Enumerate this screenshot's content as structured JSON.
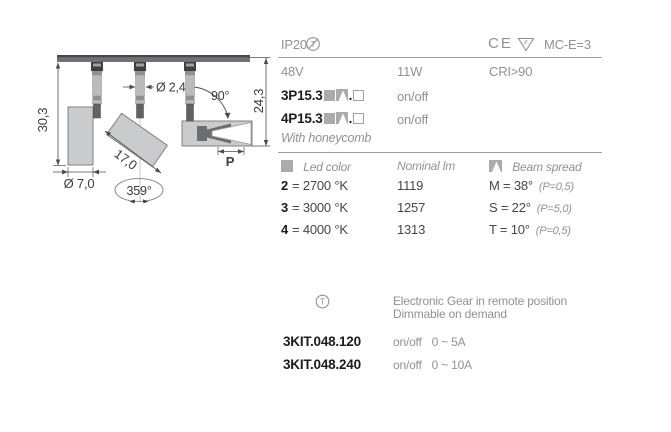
{
  "drawing": {
    "dim_height": "30,3",
    "dim_body_diameter": "Ø 7,0",
    "dim_stem_diameter": "Ø 2,4",
    "dim_length": "17,0",
    "dim_rotation": "359°",
    "dim_tilt": "90°",
    "dim_height2": "24,3",
    "dim_projection": "P"
  },
  "header": {
    "ip": "IP20",
    "t_symbol": "T",
    "ce": "CE",
    "f_symbol": "F",
    "mc": "MC-E=3"
  },
  "power": {
    "voltage": "48V",
    "wattage": "11W",
    "cri": "CRI>90"
  },
  "products": [
    {
      "code": "3P15.3",
      "dot": ".",
      "control": "on/off"
    },
    {
      "code": "4P15.3",
      "dot": ".",
      "control": "on/off"
    }
  ],
  "honeycomb_note": "With honeycomb",
  "table": {
    "headers": {
      "led_color": "Led color",
      "nominal_lm": "Nominal lm",
      "beam_spread": "Beam spread"
    },
    "rows": [
      {
        "led_key": "2",
        "led_rest": "= 2700 °K",
        "lm": "1119",
        "beam": "M = 38°",
        "p": "(P=0,5)"
      },
      {
        "led_key": "3",
        "led_rest": "= 3000 °K",
        "lm": "1257",
        "beam": "S = 22°",
        "p": "(P=5,0)"
      },
      {
        "led_key": "4",
        "led_rest": "= 4000 °K",
        "lm": "1313",
        "beam": "T = 10°",
        "p": "(P=0,5)"
      }
    ]
  },
  "gear": {
    "t_symbol": "T",
    "note_line1": "Electronic Gear in remote position",
    "note_line2": "Dimmable on demand",
    "kits": [
      {
        "code": "3KIT.048.120",
        "control": "on/off",
        "range": "0 ~ 5A"
      },
      {
        "code": "3KIT.048.240",
        "control": "on/off",
        "range": "0 ~ 10A"
      }
    ]
  },
  "colors": {
    "text_gray": "#8f9295",
    "text_dark": "#44474a",
    "text_black": "#1c1c1e",
    "fixture_fill": "#c9cbcd",
    "rail_fill": "#6f7174",
    "line": "#9b9ea1"
  }
}
